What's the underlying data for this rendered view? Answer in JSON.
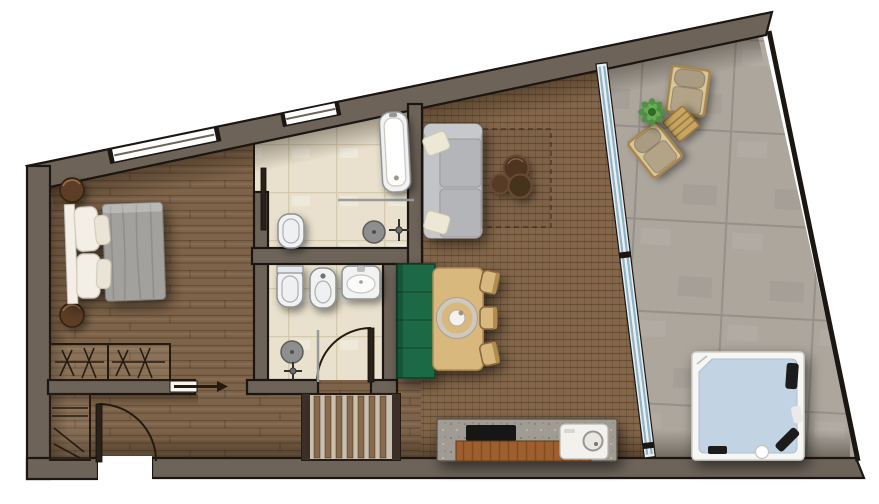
{
  "meta": {
    "type": "floor-plan",
    "view": "top-down",
    "background": "#ffffff"
  },
  "palette": {
    "wall": "#6d6359",
    "wallStroke": "#1b1612",
    "woodPlank": "#7d6349",
    "weave": "#84674b",
    "tile": "#e9e1cd",
    "tileLine": "#d5caaf",
    "stone": "#aca69d",
    "stoneLine": "#97908a",
    "glassFill": "#e9eff3",
    "glassLine": "#8fb3c6",
    "fixtureWhite": "#f2f2f0",
    "fixtureStroke": "#8a9094",
    "benchGreen": "#1e6b45",
    "tableWood": "#d9b87d",
    "sofaGray": "#bcbdc0",
    "pillowCream": "#ede7d5",
    "duvetGray": "#a3a19d",
    "linenWhite": "#f3efe6",
    "stoolWood": "#5d3d26",
    "counterStone": "#a09c93",
    "counterWood": "#9d5f2e",
    "cooktopBlack": "#151515",
    "tubWater": "#c2d4e3",
    "plantGreen": "#4c8f3f",
    "rattan": "#c9a55f",
    "cushionBeige": "#b3a488",
    "stairSlat": "#8a6a4a",
    "stairBase": "#c9bfae",
    "doorDark": "#2b2119"
  },
  "rooms": [
    {
      "id": "bedroom",
      "floor": "wood-plank"
    },
    {
      "id": "bathroom-1",
      "floor": "beige-tile",
      "fixtures": [
        "bathtub",
        "toilet",
        "walk-in-shower",
        "pocket-door"
      ]
    },
    {
      "id": "bathroom-2",
      "floor": "beige-tile",
      "fixtures": [
        "toilet",
        "bidet",
        "washbasin",
        "walk-in-shower",
        "swing-door"
      ]
    },
    {
      "id": "hallway",
      "floor": "wood-plank"
    },
    {
      "id": "living-dining",
      "floor": "woven-wood"
    },
    {
      "id": "terrace",
      "floor": "stone-tile"
    }
  ],
  "furniture": {
    "bedroom": [
      "double-bed",
      "pillows",
      "nightstand-round-1",
      "nightstand-round-2",
      "wardrobe-two-section"
    ],
    "hallway": [
      "entrance-door",
      "shoe-closet",
      "pocket-sliding-door",
      "slatted-staircase"
    ],
    "living-dining": [
      "two-seat-sofa",
      "cream-cushions",
      "coffee-table-trio",
      "area-rug",
      "green-bench",
      "dining-table",
      "dining-chairs-3",
      "round-centerpiece",
      "kitchen-counter",
      "cooktop",
      "round-sink"
    ],
    "terrace": [
      "lounge-chair-1",
      "lounge-chair-2",
      "slatted-side-table",
      "potted-plant",
      "hot-tub"
    ]
  },
  "openings": {
    "windows": 2,
    "entrance_doors": 1,
    "sliding_glass_walls": 1,
    "interior_doors": 3
  }
}
